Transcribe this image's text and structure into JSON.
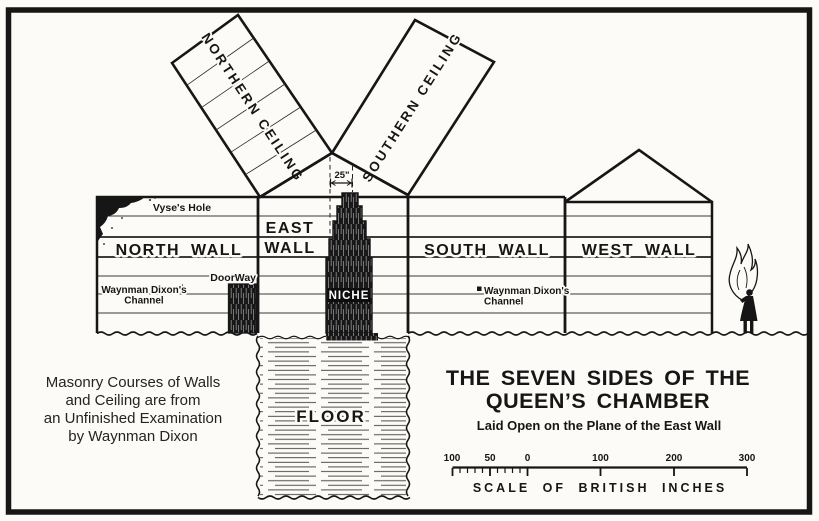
{
  "diagram": {
    "ceilings": {
      "northern": "NORTHERN CEILING",
      "southern": "SOUTHERN CEILING"
    },
    "walls": {
      "north": "NORTH WALL",
      "east_line1": "EAST",
      "east_line2": "WALL",
      "south": "SOUTH WALL",
      "west": "WEST WALL"
    },
    "features": {
      "vyses_hole": "Vyse's Hole",
      "doorway": "DoorWay",
      "niche": "NICHE",
      "floor": "FLOOR",
      "channel_line1": "Waynman Dixon's",
      "channel_line2": "Channel",
      "apex_dimension": "25\""
    }
  },
  "note": {
    "line1": "Masonry Courses of Walls",
    "line2": "and Ceiling are from",
    "line3": "an Unfinished Examination",
    "line4": "by Waynman Dixon"
  },
  "title": {
    "line1": "THE SEVEN SIDES OF THE",
    "line2": "QUEEN’S CHAMBER",
    "subtitle": "Laid Open on the Plane of the East Wall"
  },
  "scale": {
    "caption": "SCALE OF BRITISH INCHES",
    "left_ticks": [
      "100",
      "50",
      "0"
    ],
    "right_ticks": [
      "100",
      "200",
      "300"
    ]
  },
  "colors": {
    "ink": "#161616",
    "paper": "#fcfbf7"
  }
}
